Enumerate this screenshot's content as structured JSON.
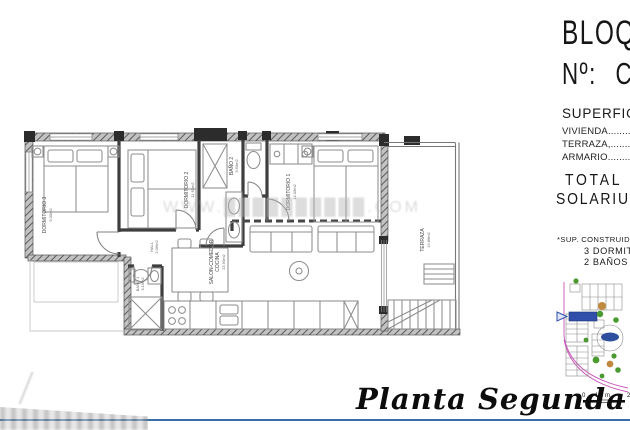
{
  "title_block": {
    "building_label": "BLOQUE",
    "number_label": "Nº:",
    "number_value": "C",
    "surfaces_title": "SUPERFICIES",
    "surface_rows": [
      "VIVIENDA....................................",
      "TERRAZA,...................................",
      "ARMARIO...................................."
    ],
    "total_line": "TOTAL  _ 9",
    "solarium_line": "SOLARIUM_",
    "footnote": "*SUP. CONSTRUIDAS",
    "program_line1": "3 DORMITORIOS",
    "program_line2": "2 BAÑOS"
  },
  "plan": {
    "rooms": {
      "dorm3": {
        "name": "DORMITORIO 3",
        "area": "9.00m2"
      },
      "dorm2": {
        "name": "DORMITORIO 2",
        "area": "11.62m2"
      },
      "bano2": {
        "name": "BAÑO 2",
        "area": "3.60m2"
      },
      "dorm1": {
        "name": "DORMITORIO 1",
        "area": "14.09m2"
      },
      "hall": {
        "name": "HALL",
        "area": "2.06m2"
      },
      "bano1": {
        "name": "BAÑO 1",
        "area": "3.16m2"
      },
      "salon": {
        "name": "SALON-COMEDOR",
        "name2": "COCINA",
        "area": "23.90m2"
      },
      "terraza": {
        "name": "TERRAZA",
        "area": "13.86m2"
      }
    },
    "watermark": "WWW.██████████.COM"
  },
  "sitemap": {
    "scale_start": "0",
    "scale_mid": "1.0 m.",
    "scale_end": "2"
  },
  "footer": {
    "plan_title": "Planta Segunda"
  },
  "colors": {
    "accent_blue": "#3a6ea8",
    "site_magenta": "#cc55bb",
    "site_unit_blue": "#2f4faa",
    "tree_green": "#4a9b2f",
    "wall_gray": "#3e3e3e"
  }
}
